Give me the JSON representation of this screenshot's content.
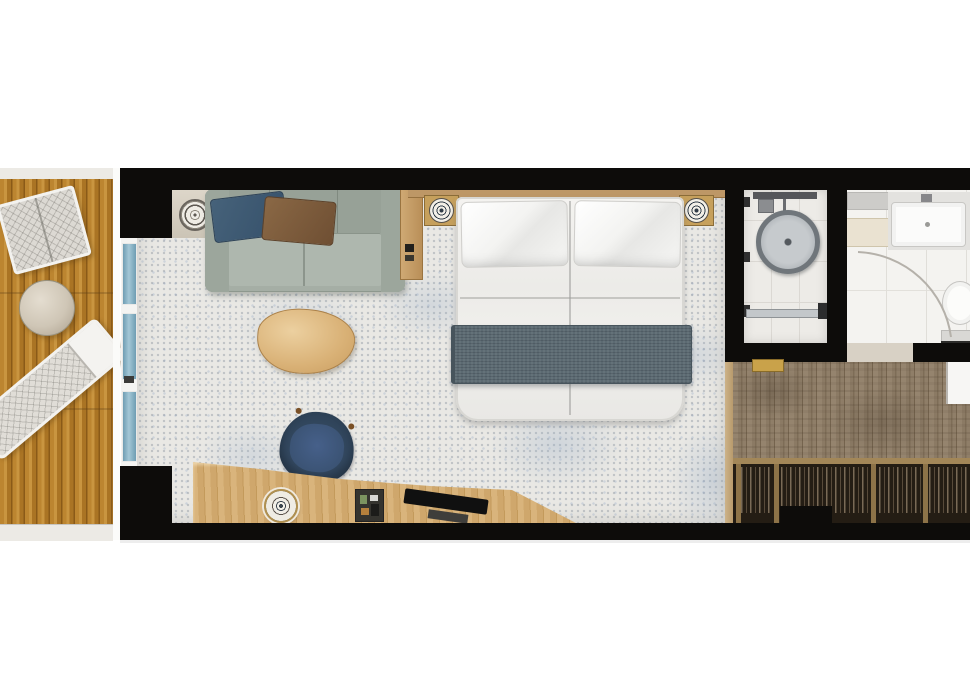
{
  "scene": {
    "kind": "architectural-floor-plan",
    "view": "top-down",
    "subject": "balcony stateroom / hotel room floor plan",
    "visible_text": "none"
  },
  "areas": {
    "balcony": {
      "name": "balcony",
      "floor": "teak wood planks",
      "items": [
        "quilted armchair",
        "round side table",
        "sun lounger"
      ]
    },
    "living_bedroom": {
      "name": "living and sleeping area",
      "floor": "speckled light carpet",
      "items": [
        "sofa with navy and brown pillows",
        "triangular coffee table",
        "double bed with gray runner",
        "two ornate nightstand lamps",
        "wood side shelf",
        "ceiling speaker",
        "desk",
        "navy desk chair",
        "ornate desk lamp",
        "minibar tray",
        "tv"
      ]
    },
    "shower_room": {
      "name": "shower",
      "floor": "tile",
      "items": [
        "rain shower head",
        "shower valve",
        "glass door track",
        "door handle"
      ]
    },
    "bathroom": {
      "name": "bathroom",
      "floor": "tile",
      "items": [
        "vanity sink with faucet",
        "mirror cabinet",
        "toiletry shelf",
        "toilet",
        "door swing arc",
        "gold threshold"
      ]
    },
    "entry_hall": {
      "name": "entry hallway",
      "floor": "gray-brown wood planks",
      "items": [
        "wardrobe closet with hanging clothes",
        "entry door"
      ]
    }
  },
  "palette": {
    "wall_black": "#0d0c0a",
    "balcony_wood": "#bc8530",
    "glass_blue": "#7ba8bc",
    "carpet": "#e9e8e4",
    "carpet_fleck_blue": "#94aac6",
    "sofa_green_gray": "#a5aea5",
    "pillow_navy": "#3d5a72",
    "pillow_brown": "#7d5b3c",
    "coffee_table_wood": "#d9b176",
    "bed_white": "#f1f0ed",
    "runner_slate": "#5c6a72",
    "desk_wood": "#d0a96e",
    "chair_navy": "#33475e",
    "hall_wood": "#8a7a64",
    "closet_dark": "#241d14",
    "gold_accent": "#c9a24a",
    "tile_white": "#f4f3f0",
    "headboard_wood": "#bd9766"
  }
}
